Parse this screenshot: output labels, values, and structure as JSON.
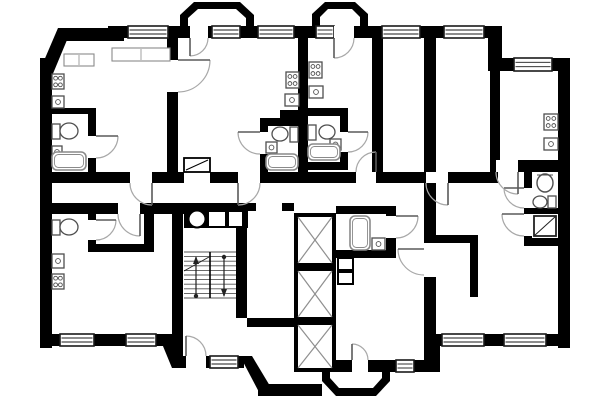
{
  "scene": {
    "width": 600,
    "height": 400,
    "background": "#ffffff",
    "kind": "apartment-floor-plan"
  },
  "styles": {
    "wall_fill": "#000000",
    "window_stroke": "#1a1a1a",
    "door_arc": "#a8a8a8",
    "door_leaf": "#5a5a5a",
    "fixture_stroke": "#4f4f4f",
    "tub_stroke": "#8a8a8a",
    "stair_stroke": "#555555",
    "shaft_diag": "#8f8f8f"
  },
  "walls": {
    "rects": [
      [
        40,
        58,
        12,
        290
      ],
      [
        58,
        28,
        58,
        13
      ],
      [
        108,
        26,
        16,
        15
      ],
      [
        116,
        26,
        12,
        12
      ],
      [
        168,
        26,
        22,
        12
      ],
      [
        208,
        26,
        4,
        12
      ],
      [
        240,
        26,
        18,
        12
      ],
      [
        294,
        26,
        22,
        12
      ],
      [
        354,
        26,
        28,
        12
      ],
      [
        420,
        26,
        24,
        12
      ],
      [
        484,
        26,
        18,
        12
      ],
      [
        488,
        26,
        14,
        45
      ],
      [
        502,
        58,
        12,
        13
      ],
      [
        552,
        58,
        18,
        13
      ],
      [
        558,
        58,
        12,
        290
      ],
      [
        428,
        334,
        14,
        12
      ],
      [
        484,
        334,
        20,
        12
      ],
      [
        546,
        334,
        24,
        12
      ],
      [
        428,
        334,
        12,
        38
      ],
      [
        316,
        360,
        36,
        12
      ],
      [
        368,
        360,
        28,
        12
      ],
      [
        414,
        360,
        26,
        12
      ],
      [
        174,
        356,
        12,
        12
      ],
      [
        206,
        356,
        4,
        12
      ],
      [
        238,
        356,
        6,
        12
      ],
      [
        44,
        334,
        16,
        12
      ],
      [
        94,
        334,
        32,
        12
      ],
      [
        156,
        334,
        16,
        12
      ],
      [
        52,
        172,
        78,
        11
      ],
      [
        152,
        172,
        32,
        11
      ],
      [
        210,
        172,
        28,
        11
      ],
      [
        260,
        172,
        96,
        11
      ],
      [
        376,
        172,
        50,
        11
      ],
      [
        448,
        172,
        50,
        11
      ],
      [
        167,
        38,
        11,
        22
      ],
      [
        167,
        92,
        11,
        80
      ],
      [
        298,
        38,
        10,
        145
      ],
      [
        372,
        38,
        11,
        134
      ],
      [
        424,
        38,
        12,
        134
      ],
      [
        424,
        183,
        12,
        60
      ],
      [
        490,
        71,
        10,
        90
      ],
      [
        490,
        160,
        6,
        12
      ],
      [
        518,
        160,
        44,
        12
      ],
      [
        524,
        172,
        8,
        16
      ],
      [
        524,
        208,
        8,
        6
      ],
      [
        524,
        236,
        8,
        10
      ],
      [
        532,
        208,
        30,
        6
      ],
      [
        524,
        238,
        46,
        8
      ],
      [
        424,
        235,
        54,
        8
      ],
      [
        470,
        243,
        8,
        54
      ],
      [
        424,
        277,
        12,
        83
      ],
      [
        52,
        108,
        44,
        6
      ],
      [
        88,
        114,
        8,
        22
      ],
      [
        88,
        158,
        8,
        14
      ],
      [
        52,
        203,
        66,
        11
      ],
      [
        140,
        203,
        44,
        11
      ],
      [
        172,
        203,
        11,
        153
      ],
      [
        88,
        214,
        8,
        6
      ],
      [
        88,
        240,
        8,
        4
      ],
      [
        88,
        244,
        66,
        8
      ],
      [
        144,
        214,
        10,
        30
      ],
      [
        236,
        228,
        11,
        90
      ],
      [
        184,
        203,
        64,
        25
      ],
      [
        248,
        203,
        8,
        8
      ],
      [
        282,
        203,
        12,
        8
      ],
      [
        247,
        318,
        47,
        9
      ],
      [
        260,
        118,
        40,
        8
      ],
      [
        260,
        118,
        8,
        14
      ],
      [
        260,
        154,
        8,
        18
      ],
      [
        280,
        110,
        18,
        8
      ],
      [
        308,
        108,
        40,
        8
      ],
      [
        340,
        116,
        8,
        16
      ],
      [
        340,
        152,
        8,
        14
      ],
      [
        308,
        162,
        40,
        8
      ],
      [
        336,
        206,
        58,
        8
      ],
      [
        386,
        206,
        10,
        10
      ],
      [
        386,
        238,
        10,
        20
      ],
      [
        336,
        250,
        60,
        8
      ],
      [
        258,
        384,
        64,
        12
      ]
    ],
    "polygons": [
      {
        "name": "chamfer-top-left",
        "points": "40,70 58,28 72,28 52,76"
      },
      {
        "name": "chamfer-bottom-left",
        "points": "158,334 172,334 186,368 172,368"
      },
      {
        "name": "porch-chamfer",
        "points": "240,356 252,356 270,386 260,394"
      }
    ]
  },
  "balconies": [
    {
      "name": "balcony-top-left",
      "outer": "M180,32 L180,15 L194,2 L240,2 L254,15 L254,32 Z",
      "inner": "M188,32 L188,18 L198,9 L236,9 L246,18 L246,32 Z"
    },
    {
      "name": "balcony-top-center",
      "outer": "M312,30 L312,14 L325,2 L355,2 L368,14 L368,30 Z",
      "inner": "M320,30 L320,17 L328,9 L352,9 L360,17 L360,30 Z"
    },
    {
      "name": "balcony-bottom-center",
      "outer": "M322,370 L322,381 L336,396 L376,396 L390,381 L390,370 Z",
      "inner": "M330,370 L330,378 L339,388 L373,388 L382,378 L382,370 Z"
    }
  ],
  "windows": [
    {
      "name": "window-1",
      "r": [
        128,
        26,
        40,
        12
      ]
    },
    {
      "name": "window-2",
      "r": [
        212,
        26,
        28,
        12
      ]
    },
    {
      "name": "window-3",
      "r": [
        258,
        26,
        36,
        12
      ]
    },
    {
      "name": "window-4",
      "r": [
        316,
        26,
        18,
        12
      ]
    },
    {
      "name": "window-5",
      "r": [
        382,
        26,
        38,
        12
      ]
    },
    {
      "name": "window-6",
      "r": [
        444,
        26,
        40,
        12
      ]
    },
    {
      "name": "window-7",
      "r": [
        514,
        58,
        38,
        13
      ]
    },
    {
      "name": "window-8",
      "r": [
        442,
        334,
        42,
        12
      ]
    },
    {
      "name": "window-9",
      "r": [
        504,
        334,
        42,
        12
      ]
    },
    {
      "name": "window-10",
      "r": [
        396,
        360,
        18,
        12
      ]
    },
    {
      "name": "window-11",
      "r": [
        210,
        356,
        28,
        12
      ]
    },
    {
      "name": "window-12",
      "r": [
        60,
        334,
        34,
        12
      ]
    },
    {
      "name": "window-13",
      "r": [
        126,
        334,
        30,
        12
      ]
    }
  ],
  "doors": [
    {
      "name": "door-balcony-left",
      "gap": [
        190,
        26,
        18,
        12
      ],
      "arc": "M208,38 A18,18 0 0 1 190,56",
      "leaf": [
        190,
        38,
        190,
        56
      ]
    },
    {
      "name": "door-balcony-center",
      "gap": [
        334,
        26,
        20,
        12
      ],
      "arc": "M354,38 A20,20 0 0 1 334,58",
      "leaf": [
        334,
        38,
        334,
        58
      ]
    },
    {
      "name": "door-bay-room",
      "gap": [
        352,
        360,
        16,
        12
      ],
      "arc": "M368,360 A16,16 0 0 0 352,344",
      "leaf": [
        352,
        360,
        352,
        344
      ]
    },
    {
      "name": "door-entrance-porch",
      "gap": [
        186,
        356,
        20,
        12
      ],
      "arc": "M206,356 A20,20 0 0 0 186,336",
      "leaf": [
        186,
        356,
        186,
        336
      ]
    },
    {
      "name": "door-apt-upper-left",
      "gap": [
        130,
        172,
        22,
        11
      ],
      "arc": "M130,183 A22,22 0 0 0 152,205",
      "leaf": [
        152,
        183,
        152,
        205
      ]
    },
    {
      "name": "door-apt-center-left",
      "gap": [
        238,
        172,
        22,
        11
      ],
      "arc": "M260,183 A22,22 0 0 1 238,205",
      "leaf": [
        238,
        183,
        238,
        205
      ]
    },
    {
      "name": "door-apt-center-right",
      "gap": [
        356,
        172,
        20,
        11
      ],
      "arc": "M356,172 A20,20 0 0 1 376,152",
      "leaf": [
        376,
        172,
        376,
        152
      ]
    },
    {
      "name": "door-apt-right",
      "gap": [
        426,
        172,
        22,
        11
      ],
      "arc": "M426,183 A22,22 0 0 0 448,205",
      "leaf": [
        448,
        183,
        448,
        205
      ]
    },
    {
      "name": "door-bath-right",
      "gap": [
        524,
        188,
        8,
        20
      ],
      "arc": "M524,208 A20,20 0 0 1 504,188",
      "leaf": [
        524,
        188,
        504,
        188
      ]
    },
    {
      "name": "door-shower-right",
      "gap": [
        524,
        214,
        8,
        22
      ],
      "arc": "M524,236 A22,22 0 0 1 502,214",
      "leaf": [
        524,
        214,
        502,
        214
      ]
    },
    {
      "name": "door-apt-lower-left",
      "gap": [
        118,
        203,
        22,
        11
      ],
      "arc": "M118,214 A22,22 0 0 0 140,236",
      "leaf": [
        140,
        214,
        140,
        236
      ]
    },
    {
      "name": "door-bath-core",
      "gap": [
        386,
        216,
        10,
        22
      ],
      "arc": "M396,238 A22,22 0 0 0 418,216",
      "leaf": [
        396,
        216,
        418,
        216
      ]
    },
    {
      "name": "door-bay-hall",
      "gap": [
        424,
        249,
        12,
        26
      ],
      "arc": "M424,275 A26,26 0 0 1 398,249",
      "leaf": [
        424,
        249,
        398,
        249
      ]
    },
    {
      "name": "door-bath-center-left",
      "gap": [
        260,
        132,
        8,
        22
      ],
      "arc": "M260,154 A22,22 0 0 1 238,132",
      "leaf": [
        260,
        132,
        238,
        132
      ]
    },
    {
      "name": "door-bath-center-right",
      "gap": [
        340,
        132,
        8,
        20
      ],
      "arc": "M348,152 A20,20 0 0 0 368,132",
      "leaf": [
        348,
        132,
        368,
        132
      ]
    },
    {
      "name": "door-bath-upper-left",
      "gap": [
        88,
        136,
        8,
        22
      ],
      "arc": "M96,158 A22,22 0 0 0 118,136",
      "leaf": [
        96,
        136,
        118,
        136
      ]
    },
    {
      "name": "door-wc-lower-left",
      "gap": [
        88,
        220,
        8,
        20
      ],
      "arc": "M96,240 A20,20 0 0 0 116,220",
      "leaf": [
        96,
        220,
        116,
        220
      ]
    },
    {
      "name": "door-room-divider",
      "gap": [
        167,
        60,
        11,
        32
      ],
      "arc": "M178,92 A32,32 0 0 0 210,60",
      "leaf": [
        178,
        60,
        210,
        60
      ]
    },
    {
      "name": "door-kitchen-right",
      "gap": [
        496,
        160,
        22,
        12
      ],
      "arc": "M496,172 A22,22 0 0 0 518,194",
      "leaf": [
        518,
        172,
        518,
        194
      ]
    }
  ],
  "fixtures": {
    "stoves": [
      [
        52,
        74,
        12,
        15
      ],
      [
        52,
        274,
        12,
        15
      ],
      [
        286,
        72,
        13,
        16
      ],
      [
        309,
        62,
        13,
        16
      ],
      [
        544,
        114,
        14,
        16
      ]
    ],
    "sinks": [
      [
        52,
        96,
        12,
        12
      ],
      [
        52,
        254,
        12,
        14
      ],
      [
        285,
        94,
        14,
        12
      ],
      [
        309,
        86,
        14,
        12
      ],
      [
        544,
        138,
        14,
        12
      ],
      [
        266,
        142,
        11,
        11
      ],
      [
        330,
        139,
        11,
        11
      ],
      [
        52,
        146,
        10,
        12
      ],
      [
        372,
        238,
        13,
        12
      ]
    ],
    "toilets": [
      {
        "tank": [
          52,
          124,
          8,
          15
        ],
        "bowl": [
          69,
          131,
          9,
          8
        ]
      },
      {
        "tank": [
          52,
          220,
          8,
          15
        ],
        "bowl": [
          69,
          227,
          9,
          8
        ]
      },
      {
        "tank": [
          290,
          127,
          8,
          15
        ],
        "bowl": [
          280,
          134,
          8,
          7
        ]
      },
      {
        "tank": [
          308,
          125,
          8,
          15
        ],
        "bowl": [
          327,
          132,
          8,
          7
        ]
      },
      {
        "tank": [
          548,
          196,
          8,
          12
        ],
        "bowl": [
          540,
          202,
          7,
          6
        ]
      }
    ],
    "bathtubs": [
      [
        52,
        152,
        34,
        18
      ],
      [
        266,
        154,
        32,
        16
      ],
      [
        308,
        144,
        32,
        16
      ],
      [
        350,
        216,
        20,
        34
      ]
    ],
    "basins": [
      {
        "cx": 545,
        "cy": 183,
        "rx": 8,
        "ry": 9
      }
    ],
    "showers": [
      {
        "r": [
          534,
          216,
          22,
          20
        ],
        "diag": [
          534,
          236,
          556,
          216
        ]
      }
    ],
    "counters": [
      [
        112,
        48,
        58,
        13
      ],
      [
        64,
        54,
        30,
        12
      ]
    ]
  },
  "stairs": {
    "x": 184,
    "y": 252,
    "flight_w": 25,
    "width": 52,
    "height": 46,
    "treads": 11,
    "mid_x": 210,
    "up_arrow": {
      "x": 196,
      "y1": 296,
      "y2": 257
    },
    "down_arrow": {
      "x": 224,
      "y1": 257,
      "y2": 296
    },
    "slash": [
      184,
      271,
      209,
      257
    ]
  },
  "elevators": [
    [
      294,
      213,
      42,
      54
    ],
    [
      294,
      267,
      42,
      54
    ],
    [
      294,
      321,
      42,
      51
    ]
  ],
  "chute": {
    "cx": 197,
    "cy": 219,
    "r": 8.5
  },
  "shaft_boxes": [
    [
      208,
      211,
      18,
      16
    ],
    [
      228,
      211,
      15,
      16
    ],
    [
      338,
      258,
      15,
      12
    ],
    [
      338,
      272,
      15,
      12
    ]
  ],
  "hatch_box": {
    "r": [
      184,
      158,
      26,
      14
    ],
    "diag": [
      186,
      170,
      208,
      160
    ]
  }
}
